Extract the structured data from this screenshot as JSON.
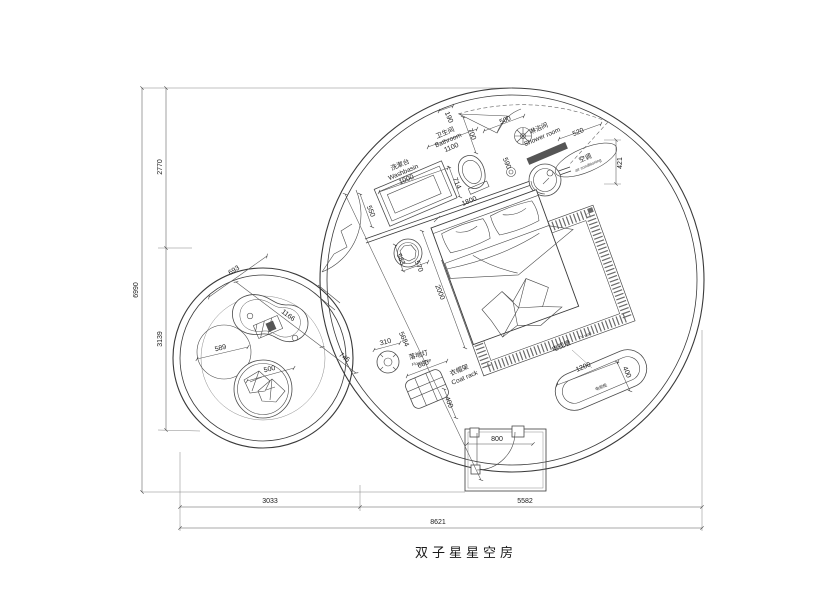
{
  "title": "双子星星空房",
  "rooms": {
    "bathroom": {
      "cn": "卫生间",
      "en": "Bathroom"
    },
    "washbasin": {
      "cn": "洗漱台",
      "en": "Washbasin"
    },
    "shower": {
      "cn": "淋浴间",
      "en": "Shower room"
    },
    "ac": {
      "cn": "空调",
      "en": "air conditioning"
    },
    "floor_lamp": {
      "cn": "落地灯",
      "en": "Floor lamp"
    },
    "coat_rack": {
      "cn": "衣帽架",
      "en": "Coat rack"
    },
    "tv_wall": {
      "cn": "电视墙",
      "en": "TV wall"
    },
    "tv_cabinet": {
      "cn": "电视柜"
    }
  },
  "dims": {
    "overall_height": "6990",
    "height_upper": "2770",
    "height_lower": "3139",
    "width_left": "3033",
    "width_right": "5582",
    "overall_width": "8621",
    "entry_door": "800",
    "bath_offset": "190",
    "bath_depth": "700",
    "bathroom_width": "1100",
    "shower_width": "500",
    "washbasin_width": "1000",
    "vanity_depth": "550",
    "toilet": "714",
    "bed_width": "1800",
    "drain": "590",
    "ac_width": "520",
    "ac_depth": "421",
    "stool_a": "583",
    "stool_b": "570",
    "bed_length": "2000",
    "room_diagonal": "5684",
    "table_a": "693",
    "table_b": "1166",
    "table_c": "745",
    "round_rug": "589",
    "pouf": "500",
    "lamp": "310",
    "rack_width": "660",
    "rack_depth": "400",
    "tv_width": "1200",
    "tv_depth": "400"
  }
}
